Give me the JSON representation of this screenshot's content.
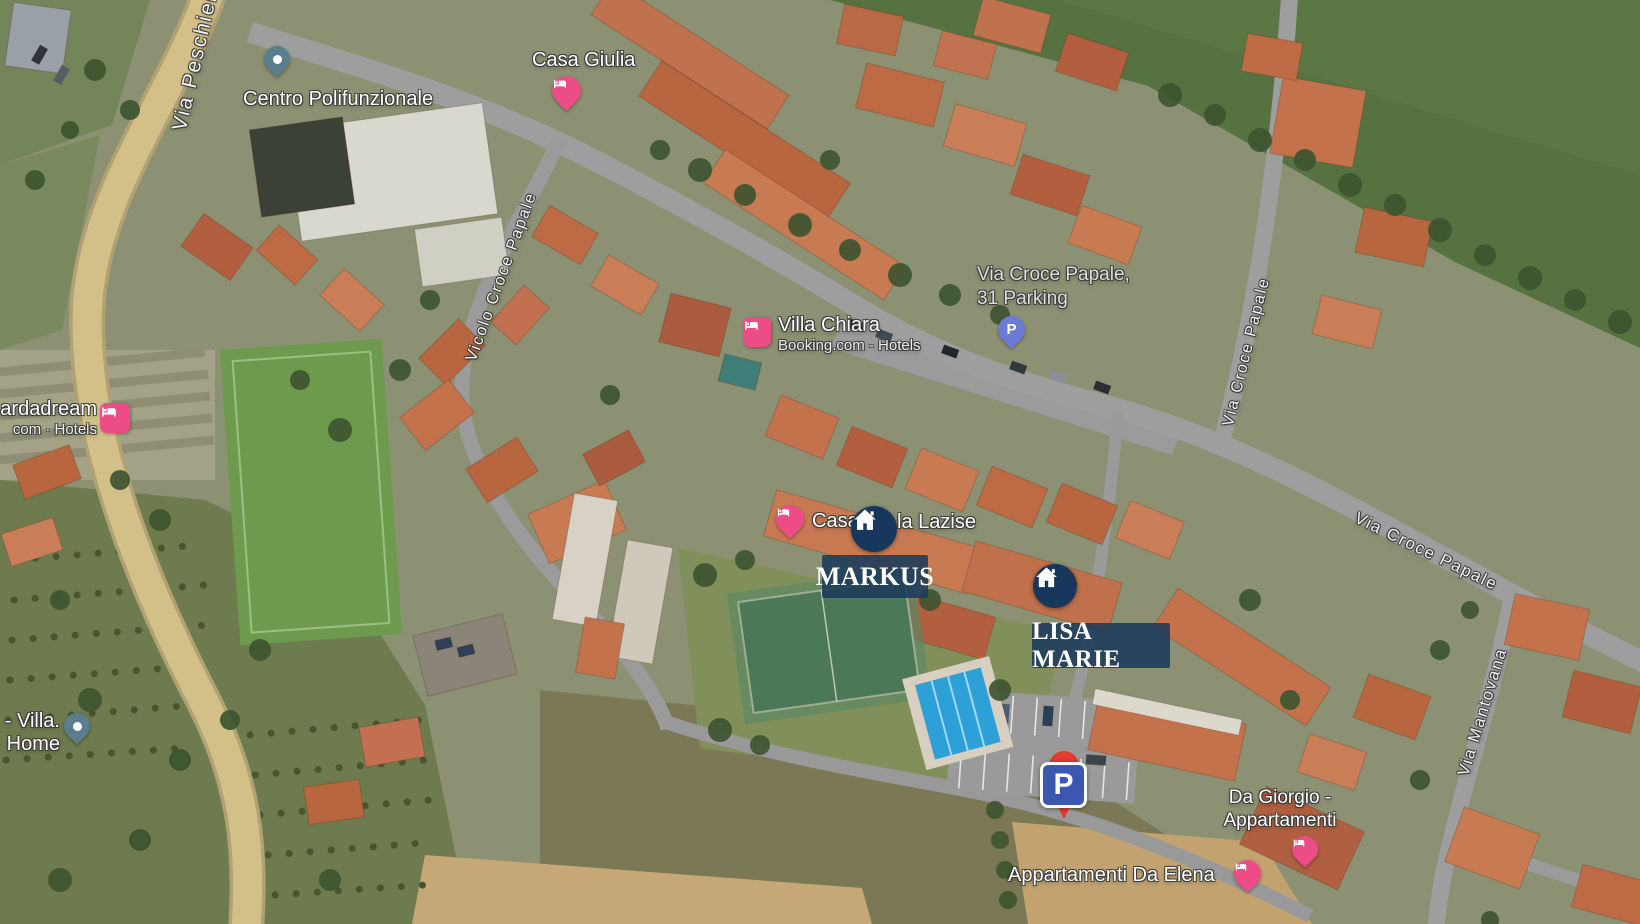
{
  "app": {
    "type": "satellite-map-view",
    "region": "Lazise residential area"
  },
  "streets": {
    "peschiera": "Via Peschiera",
    "vicolo": "Vicolo Croce Papale",
    "croce_north": "Via Croce Papale",
    "croce_east": "Via Croce Papale",
    "mantovana": "Via Mantovana"
  },
  "pois": {
    "centro": {
      "name": "Centro Polifunzionale",
      "icon": "dot-pin-icon"
    },
    "casa_giulia": {
      "name": "Casa Giulia",
      "icon": "hotel-bed-icon"
    },
    "villa_chiara": {
      "name": "Villa Chiara",
      "subtitle": "Booking.com - Hotels",
      "icon": "hotel-bed-icon"
    },
    "parking31": {
      "line1": "Via Croce Papale,",
      "line2": "31  Parking",
      "icon": "parking-p-icon"
    },
    "gardadream": {
      "line1": "ardadream",
      "line2": "com · Hotels",
      "icon": "hotel-bed-icon"
    },
    "casa_lazise": {
      "name_left": "Casa",
      "name_right": "la Lazise",
      "icon": "hotel-bed-icon"
    },
    "villa_home": {
      "line1": "- Villa.",
      "line2": "Home",
      "icon": "dot-pin-icon"
    },
    "da_giorgio": {
      "line1": "Da Giorgio -",
      "line2": "Appartamenti",
      "icon": "hotel-bed-icon"
    },
    "da_elena": {
      "name": "Appartamenti Da Elena",
      "icon": "hotel-bed-icon"
    }
  },
  "property_markers": {
    "markus": {
      "label": "MARKUS",
      "icon": "house-icon"
    },
    "lisa_marie": {
      "label": "LISA MARIE",
      "icon": "house-icon"
    }
  },
  "parking_sign": {
    "letter": "P"
  },
  "colors": {
    "hotel_pink": "#ec4d87",
    "poi_teal": "#5b7e8f",
    "parking_purple": "#6b7bd6",
    "marker_navy": "#17375c",
    "marker_label_bg": "#1b3a5a",
    "parking_sign_blue": "#3b57b0",
    "parking_pin_red": "#e23a2e",
    "field_green": "#567240",
    "road_gray": "#9e9e9e",
    "main_road_tan": "#d2c088"
  }
}
